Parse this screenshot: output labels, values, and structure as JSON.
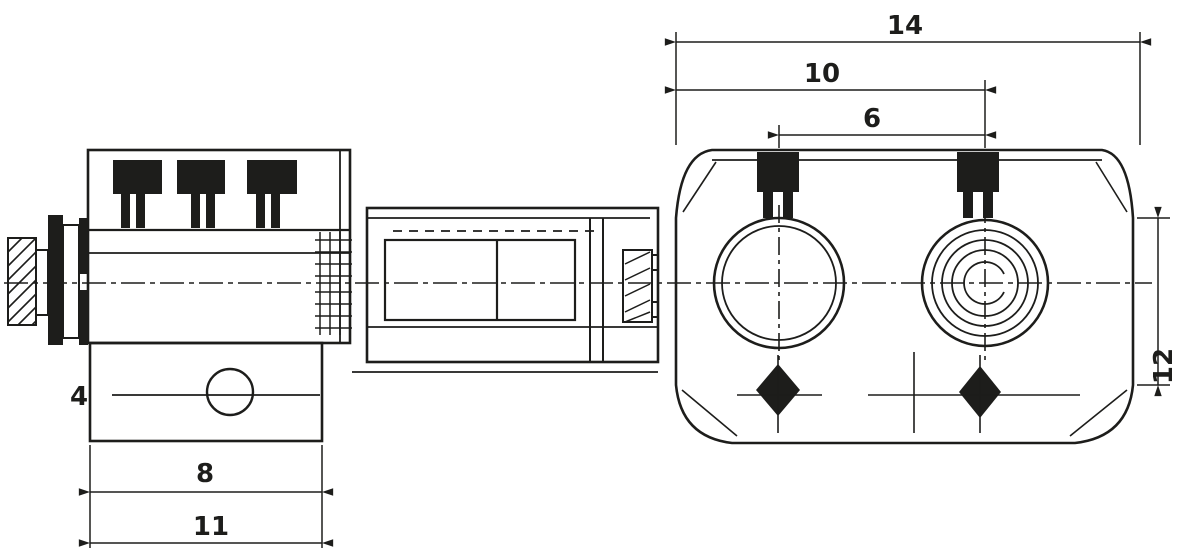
{
  "drawing": {
    "ink_color": "#1d1d1b",
    "background_color": "#ffffff",
    "dimensions": {
      "front_overall_width": {
        "value": "14"
      },
      "front_mid_width": {
        "value": "10"
      },
      "terminal_pitch": {
        "value": "6"
      },
      "front_side_height": {
        "value": "12"
      },
      "side_body_width": {
        "value": "8"
      },
      "side_overall_width": {
        "value": "11"
      },
      "port_label": {
        "value": "4"
      }
    }
  }
}
